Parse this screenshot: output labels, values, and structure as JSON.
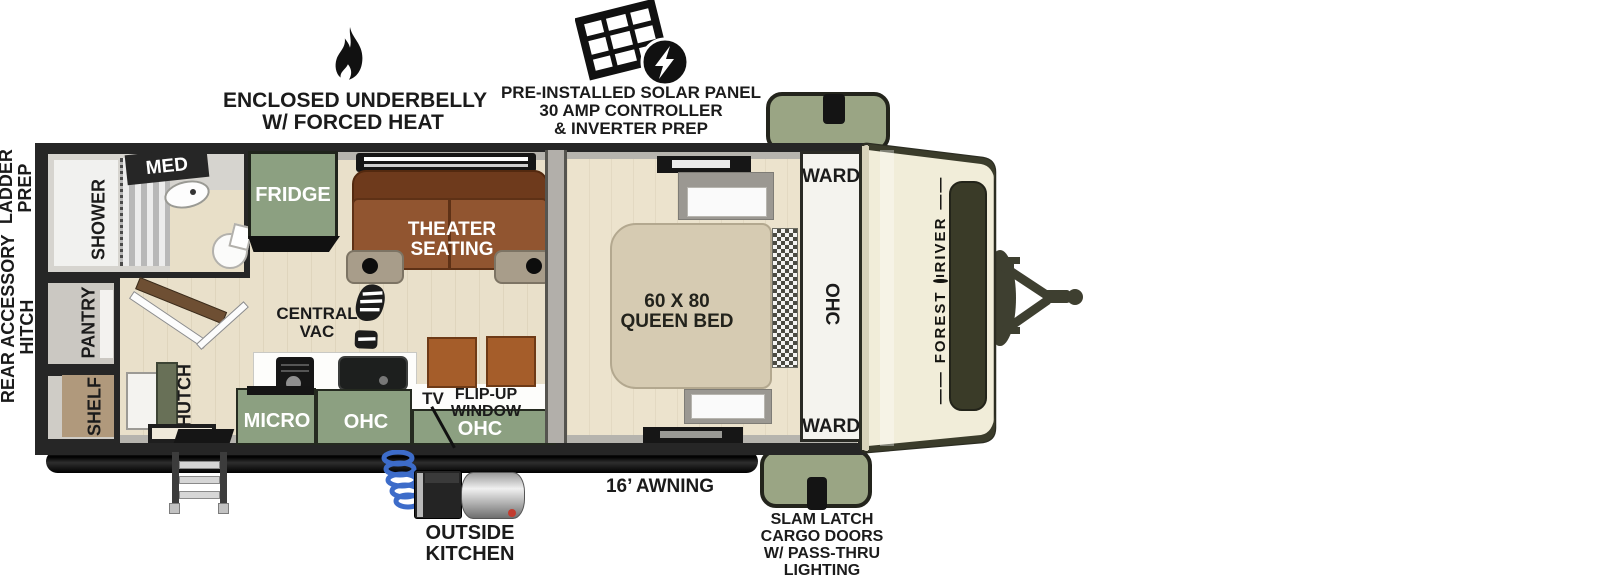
{
  "callouts": {
    "underbelly_line1": "ENCLOSED UNDERBELLY",
    "underbelly_line2": "W/ FORCED HEAT",
    "solar_line1": "PRE-INSTALLED SOLAR PANEL",
    "solar_line2": "30 AMP CONTROLLER",
    "solar_line3": "& INVERTER PREP",
    "ladder_line1": "LADDER",
    "ladder_line2": "PREP",
    "rear_hitch_line1": "REAR ACCESSORY",
    "rear_hitch_line2": "HITCH",
    "awning": "16’ AWNING",
    "outside_line1": "OUTSIDE",
    "outside_line2": "KITCHEN",
    "slam_line1": "SLAM LATCH",
    "slam_line2": "CARGO DOORS",
    "slam_line3": "W/ PASS-THRU",
    "slam_line4": "LIGHTING"
  },
  "rooms": {
    "shower": "SHOWER",
    "med": "MED",
    "pantry": "PANTRY",
    "shelf": "SHELF",
    "hutch": "HUTCH",
    "fridge": "FRIDGE",
    "theater_line1": "THEATER",
    "theater_line2": "SEATING",
    "central_vac_line1": "CENTRAL",
    "central_vac_line2": "VAC",
    "micro": "MICRO",
    "ohc_kitchen": "OHC",
    "tv": "TV",
    "flipup_line1": "FLIP-UP",
    "flipup_line2": "WINDOW",
    "ohc_door": "OHC",
    "bed_line1": "60 X 80",
    "bed_line2": "QUEEN BED",
    "ward_top": "WARD",
    "ohc_bedroom": "OHC",
    "ward_bottom": "WARD"
  },
  "brand": {
    "dash": "——",
    "word1": "FOREST",
    "word2": "RIVER"
  },
  "colors": {
    "cabinet_green": "#8ca081",
    "cargo_door_green": "#9aa584",
    "cap_cream": "#f1edd9",
    "olive_dark": "#3b3c2b",
    "sofa_brown": "#915530",
    "sofa_back_brown": "#6e3a1c",
    "ottoman_brown": "#a55d2a",
    "bed_tan": "#d6cbb2",
    "floor_beige": "#e9e0ca",
    "wall_gray": "#b6b4ae",
    "outline_black": "#262626"
  }
}
